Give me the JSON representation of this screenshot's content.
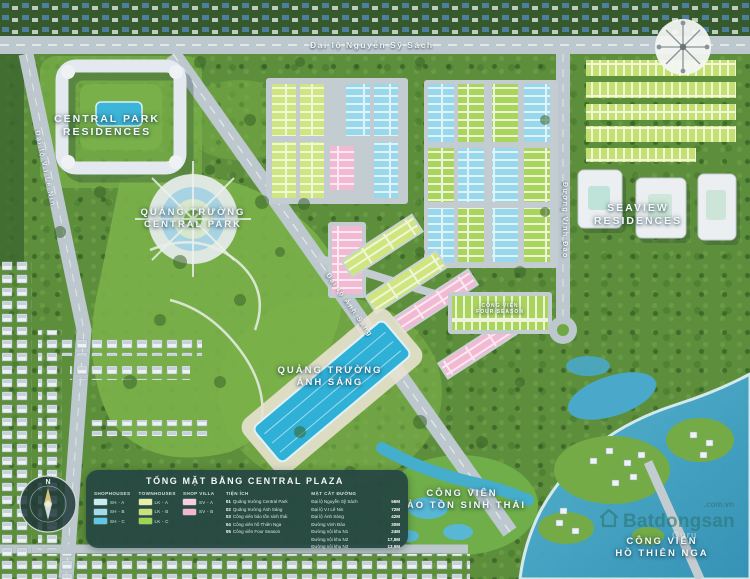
{
  "map": {
    "roads": {
      "top": "Đại lộ Nguyễn Sỹ Sách",
      "left": "Đại lộ V.I Lê Nin",
      "right": "Đường Vinh Đào",
      "diagonal": "Đại lộ Ánh Sáng"
    },
    "areas": {
      "central_park_residences": {
        "line1": "CENTRAL PARK",
        "line2": "RESIDENCES"
      },
      "quang_truong_central_park": {
        "line1": "QUẢNG TRƯỜNG",
        "line2": "CENTRAL PARK"
      },
      "seaview_residences": {
        "line1": "SEAVIEW",
        "line2": "RESIDENCES"
      },
      "quang_truong_anh_sang": {
        "line1": "QUẢNG TRƯỜNG",
        "line2": "ÁNH SÁNG"
      },
      "cong_vien_bao_ton": {
        "line1": "CÔNG VIÊN",
        "line2": "BẢO TỒN SINH THÁI"
      },
      "cong_vien_ho_thien_nga": {
        "line1": "CÔNG VIÊN",
        "line2": "HỒ THIÊN NGA"
      },
      "cong_vien_four_season": {
        "line1": "CÔNG VIÊN",
        "line2": "FOUR SEASON"
      }
    }
  },
  "legend": {
    "title": "TỔNG MẶT BẰNG CENTRAL PLAZA",
    "groups": [
      {
        "name": "SHOPHOUSES",
        "swatches": [
          {
            "color": "#c9ecf4",
            "label": "SH - A"
          },
          {
            "color": "#9fdcee",
            "label": "SH - B"
          },
          {
            "color": "#5fc8e6",
            "label": "SH - C"
          }
        ]
      },
      {
        "name": "TOWNHOUSES",
        "swatches": [
          {
            "color": "#e6f0a6",
            "label": "LK - A"
          },
          {
            "color": "#c7e27a",
            "label": "LK - B"
          },
          {
            "color": "#9ed44f",
            "label": "LK - C"
          }
        ]
      },
      {
        "name": "SHOP VILLA",
        "swatches": [
          {
            "color": "#f9cfe0",
            "label": "SV - A"
          },
          {
            "color": "#f3b5d1",
            "label": "SV - B"
          }
        ]
      }
    ],
    "amenities": {
      "name": "TIỆN ÍCH",
      "items": [
        {
          "no": "01",
          "label": "Quảng trường Central Park"
        },
        {
          "no": "02",
          "label": "Quảng trường Ánh Sáng"
        },
        {
          "no": "03",
          "label": "Công viên bảo tồn sinh thái"
        },
        {
          "no": "04",
          "label": "Công viên hồ Thiên Nga"
        },
        {
          "no": "05",
          "label": "Công viên Four Season"
        }
      ]
    },
    "sections": {
      "name": "MẶT CẮT ĐƯỜNG",
      "items": [
        {
          "label": "Đại lộ Nguyễn Sỹ Sách",
          "value": "56M"
        },
        {
          "label": "Đại lộ V.I Lê Nin",
          "value": "72M"
        },
        {
          "label": "Đại lộ Ánh Sáng",
          "value": "42M"
        },
        {
          "label": "Đường Vinh Đào",
          "value": "30M"
        },
        {
          "label": "Đường nội khu N1",
          "value": "24M"
        },
        {
          "label": "Đường nội khu N2",
          "value": "17,5M"
        },
        {
          "label": "Đường nội khu N3",
          "value": "13,5M"
        }
      ]
    }
  },
  "watermark": {
    "brand": "Batdongsan",
    "suffix": ".com.vn",
    "guru": "Guru"
  },
  "colors": {
    "legend_panel": "#264844",
    "water": "#4aa9ca",
    "shophouse": "#9fdcee",
    "townhouse": "#c7e27a",
    "shop_villa": "#f3b5d1",
    "road": "#bcc8cd"
  }
}
